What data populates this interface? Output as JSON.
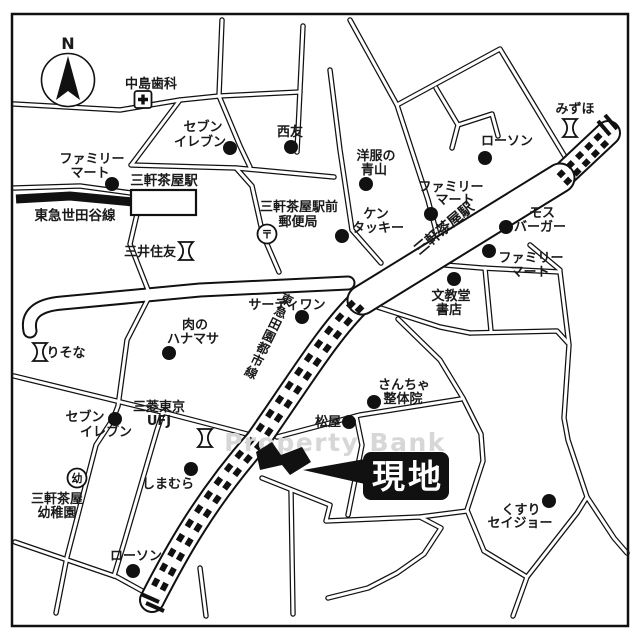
{
  "compass": {
    "label": "N"
  },
  "watermark": "Property Bank",
  "site_marker": {
    "label": "現地"
  },
  "railways": {
    "denentoshi": {
      "line_label": "東急田園都市線",
      "station_label": "三軒茶屋駅"
    },
    "setagaya": {
      "line_label": "東急世田谷線",
      "station_label": "三軒茶屋駅"
    }
  },
  "symbols": {
    "post_office": "〒",
    "kindergarten": "幼"
  },
  "landmarks": [
    {
      "id": "nakajima-dental",
      "label": "中島歯科",
      "lines": [
        "中島歯科"
      ],
      "marker": "hospital-icon"
    },
    {
      "id": "seven-eleven-north",
      "label": "セブンイレブン",
      "lines": [
        "セブン",
        "イレブン"
      ],
      "marker": "dot"
    },
    {
      "id": "seiyu",
      "label": "西友",
      "lines": [
        "西友"
      ],
      "marker": "dot"
    },
    {
      "id": "familymart-west",
      "label": "ファミリーマート",
      "lines": [
        "ファミリー",
        "マート"
      ],
      "marker": "dot"
    },
    {
      "id": "mitsui-sumitomo-bank",
      "label": "三井住友",
      "lines": [
        "三井住友"
      ],
      "marker": "bank-icon"
    },
    {
      "id": "sangenjaya-ekimae-post-office",
      "label": "三軒茶屋駅前郵便局",
      "lines": [
        "三軒茶屋駅前",
        "郵便局"
      ],
      "marker": "post-office-icon"
    },
    {
      "id": "yofuku-no-aoyama",
      "label": "洋服の青山",
      "lines": [
        "洋服の",
        "青山"
      ],
      "marker": "dot"
    },
    {
      "id": "kentucky",
      "label": "ケンタッキー",
      "lines": [
        "ケン",
        "タッキー"
      ],
      "marker": "dot"
    },
    {
      "id": "lawson-north",
      "label": "ローソン",
      "lines": [
        "ローソン"
      ],
      "marker": "dot"
    },
    {
      "id": "mizuho-bank",
      "label": "みずほ",
      "lines": [
        "みずほ"
      ],
      "marker": "bank-icon"
    },
    {
      "id": "familymart-center",
      "label": "ファミリーマート",
      "lines": [
        "ファミリー",
        "マート"
      ],
      "marker": "dot"
    },
    {
      "id": "mos-burger",
      "label": "モスバーガー",
      "lines": [
        "モス",
        "バーガー"
      ],
      "marker": "dot"
    },
    {
      "id": "familymart-east",
      "label": "ファミリーマート",
      "lines": [
        "ファミリー",
        "マート"
      ],
      "marker": "dot"
    },
    {
      "id": "bunkyodo-shoten",
      "label": "文教堂書店",
      "lines": [
        "文教堂",
        "書店"
      ],
      "marker": "dot"
    },
    {
      "id": "thirty-one",
      "label": "サーティワン",
      "lines": [
        "サーティワン"
      ],
      "marker": "dot"
    },
    {
      "id": "niku-no-hanamasa",
      "label": "肉のハナマサ",
      "lines": [
        "肉の",
        "ハナマサ"
      ],
      "marker": "dot"
    },
    {
      "id": "risona-bank",
      "label": "りそな",
      "lines": [
        "りそな"
      ],
      "marker": "bank-icon"
    },
    {
      "id": "mitsubishi-tokyo-ufj-bank",
      "label": "三菱東京UFJ",
      "lines": [
        "三菱東京",
        "UFJ"
      ],
      "marker": "bank-icon"
    },
    {
      "id": "seven-eleven-south",
      "label": "セブンイレブン",
      "lines": [
        "セブン",
        "イレブン"
      ],
      "marker": "dot"
    },
    {
      "id": "sancha-seitaiin",
      "label": "さんちゃ整体院",
      "lines": [
        "さんちゃ",
        "整体院"
      ],
      "marker": "dot"
    },
    {
      "id": "matsuya",
      "label": "松屋",
      "lines": [
        "松屋"
      ],
      "marker": "dot"
    },
    {
      "id": "sangenjaya-kindergarten",
      "label": "三軒茶屋幼稚園",
      "lines": [
        "三軒茶屋",
        "幼稚園"
      ],
      "marker": "kindergarten-icon"
    },
    {
      "id": "shimamura",
      "label": "しまむら",
      "lines": [
        "しまむら"
      ],
      "marker": "dot"
    },
    {
      "id": "lawson-south",
      "label": "ローソン",
      "lines": [
        "ローソン"
      ],
      "marker": "dot"
    },
    {
      "id": "kusuri-seijo",
      "label": "くすりセイジョー",
      "lines": [
        "くすり",
        "セイジョー"
      ],
      "marker": "dot"
    }
  ]
}
